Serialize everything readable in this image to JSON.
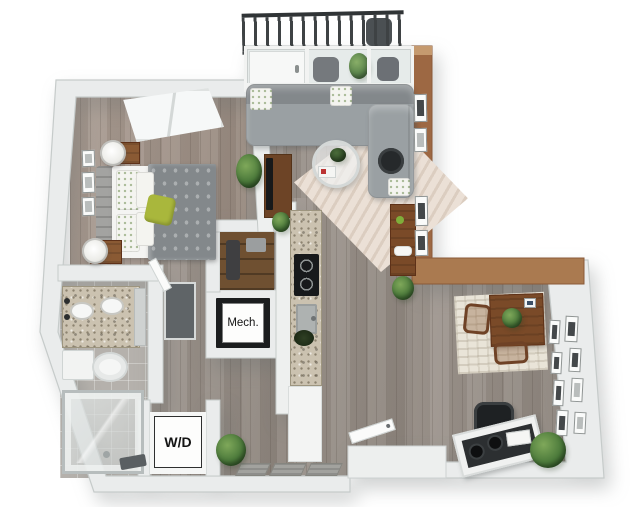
{
  "image_type": "3d-apartment-floor-plan-rendering",
  "labels": {
    "mech_room": "Mech.",
    "laundry": "W/D"
  },
  "palette": {
    "background": "#ffffff",
    "wall": "#eaecec",
    "wall_edge": "#c6cbca",
    "accent_wall": "#9d6843",
    "accent_wall_cap": "#c59a6f",
    "wood_floor": "#978e86",
    "bedroom_floor": "#a29388",
    "tile_floor": "#b5b1ac",
    "sofa_gray": "#9aa0a3",
    "bed_duvet": "#83888b",
    "accent_pillow": "#a9b73c",
    "granite": "#cbc2b0",
    "furniture_wood": "#7a4a28",
    "plant_green": "#4c7a3b",
    "railing_dark": "#3e4244",
    "appliance_black": "#1b1d1e",
    "label_text": "#141414"
  },
  "objects": [
    "balcony-railing",
    "balcony-chair",
    "balcony-plant",
    "window-wall",
    "sliding-door",
    "bedroom-window",
    "bed",
    "headboard",
    "duvet",
    "pillows",
    "accent-pillow",
    "nightstand",
    "table-lamp",
    "picture-frame",
    "bedroom-plant",
    "tv-console",
    "tv",
    "closet",
    "sectional-sofa",
    "coffee-table",
    "living-rug",
    "media-console",
    "accent-wall-frames",
    "kitchen-counter",
    "cooktop",
    "kitchen-sink",
    "mech-unit",
    "washer-dryer-closet",
    "bathroom-vanity",
    "vanity-sink",
    "toilet",
    "shower",
    "bath-mat",
    "bathroom-sliding-door",
    "entry-door",
    "door-mats",
    "dining-table",
    "dining-chair",
    "dining-rug",
    "gallery-frames",
    "office-chair",
    "desk",
    "desk-speakers",
    "office-plant",
    "corner-plant"
  ]
}
